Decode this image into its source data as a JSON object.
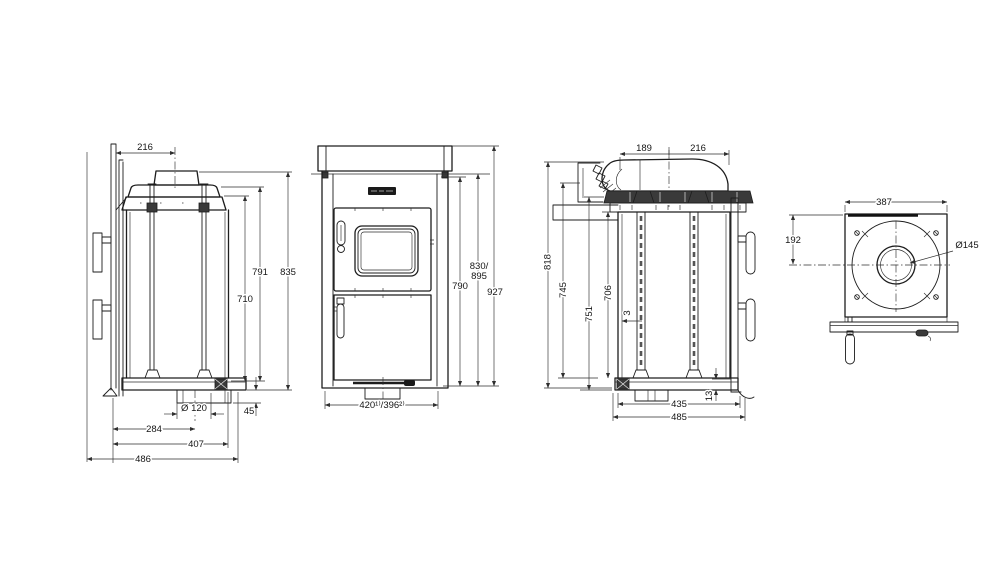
{
  "background": "#ffffff",
  "line_color": "#1d1d1d",
  "views": {
    "side_left": {
      "dims": {
        "flue_offset": "216",
        "h_body": "710",
        "h_mid": "791",
        "h_total": "835",
        "base_diameter": "Ø 120",
        "base_drop": "45",
        "d_center": "284",
        "d_mid": "407",
        "d_total": "486"
      }
    },
    "front": {
      "dims": {
        "h_casing": "790",
        "h_variant_line1": "830/",
        "h_variant_line2": "895",
        "h_total": "927",
        "w_bottom": "420¹⁾/396²⁾"
      }
    },
    "side_right": {
      "dims": {
        "top_left": "189",
        "top_right": "216",
        "h_total": "818",
        "h_a": "745",
        "h_b": "751",
        "h_c": "706",
        "gap": "3",
        "d_inner": "435",
        "d_total": "485",
        "base_lip": "13"
      }
    },
    "top": {
      "dims": {
        "width": "387",
        "flue_offset": "192",
        "flue_diameter": "Ø145"
      }
    }
  }
}
